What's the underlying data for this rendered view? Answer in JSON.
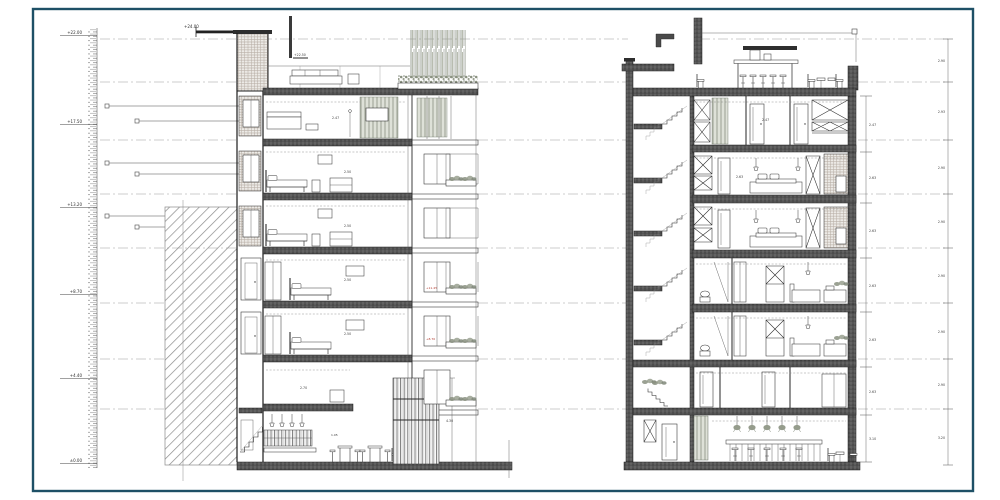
{
  "sheet": {
    "type": "architectural-building-sections",
    "background": "#ffffff",
    "frame_color": "#1e5066"
  },
  "ruler": {
    "labels": [
      "+22.00",
      "+17.50",
      "+13.20",
      "+8.70",
      "+4.40",
      "±0.00"
    ]
  },
  "annotations": {
    "roof_level": "+24.00",
    "terrace_level": "+22.50"
  },
  "left_section": {
    "dims": {
      "f5": "2.47",
      "f4": "2.50",
      "f3": "2.50",
      "f2": "2.50",
      "f1": "2.50",
      "mezz": "2.70",
      "bar": "1.05",
      "screen": "4.30"
    },
    "facade_tags": [
      "+11.45",
      "+8.70"
    ]
  },
  "right_section": {
    "interior_dims": {
      "f6": "2.47",
      "f5": "2.63"
    },
    "inner_chain": [
      "2.47",
      "2.63",
      "2.63",
      "2.63",
      "2.63",
      "2.63",
      "3.10"
    ],
    "outer_chain": [
      "2.90",
      "2.93",
      "2.90",
      "2.90",
      "2.90",
      "2.90",
      "2.90",
      "3.20"
    ]
  },
  "colors": {
    "frame": "#1e5066",
    "line": "#262626",
    "slab": "#4a4a4a",
    "hatch": "#8c8c8c",
    "vegetation": "#8a9180",
    "red_tag": "#b03a2e"
  }
}
